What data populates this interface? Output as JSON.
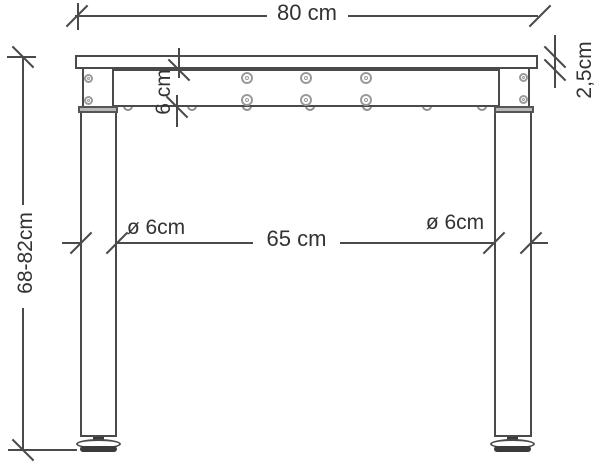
{
  "diagram": {
    "title": "height-adjustable desk frame side elevation",
    "colors": {
      "line": "#4a4a4a",
      "text": "#333333",
      "background": "#ffffff",
      "collar_fill": "#b8b8b8",
      "foot_fill": "#3a3a3a"
    },
    "dimensions": {
      "tabletop_width": {
        "label": "80 cm",
        "orientation": "horizontal"
      },
      "tabletop_thickness": {
        "label": "2,5cm",
        "orientation": "vertical"
      },
      "frame_height": {
        "label": "6 cm",
        "orientation": "vertical"
      },
      "leg_height_range": {
        "label": "68-82cm",
        "orientation": "vertical"
      },
      "leg_clear_span": {
        "label": "65 cm",
        "orientation": "horizontal"
      },
      "leg_diameter_left": {
        "label": "ø 6cm",
        "orientation": "horizontal"
      },
      "leg_diameter_right": {
        "label": "ø 6cm",
        "orientation": "horizontal"
      }
    }
  }
}
